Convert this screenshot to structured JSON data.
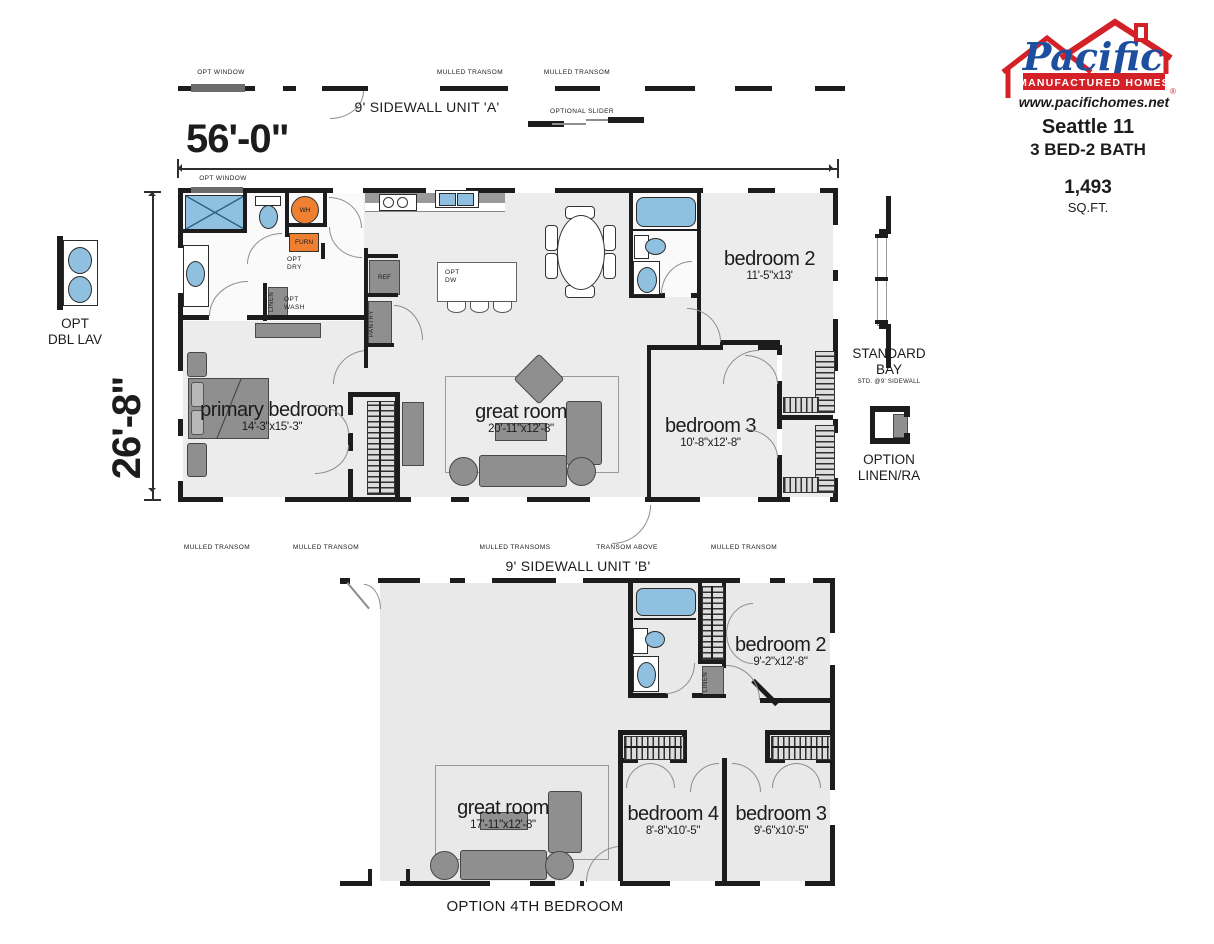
{
  "colors": {
    "brand_red": "#d42127",
    "brand_blue": "#1d4f9e",
    "fixture_blue": "#8fc0e0",
    "utility_orange": "#ef8032",
    "wall_black": "#1c1c1c",
    "floor_gray": "#ececec",
    "furniture_gray": "#8f8f8f"
  },
  "brand": {
    "script": "Pacific",
    "bar": "MANUFACTURED HOMES",
    "reg": "®",
    "website": "www.pacifichomes.net",
    "model": "Seattle 11",
    "beds_baths": "3 BED-2 BATH",
    "sqft": "1,493",
    "sqft_unit": "SQ.FT."
  },
  "dims": {
    "width": "56'-0\"",
    "height": "26'-8\""
  },
  "top": {
    "opt_window_bar": "OPT WINDOW",
    "opt_window_plan": "OPT WINDOW",
    "sidewall_a": "9' SIDEWALL UNIT 'A'",
    "mulled_1": "MULLED TRANSOM",
    "mulled_2": "MULLED TRANSOM",
    "optional_slider": "OPTIONAL SLIDER"
  },
  "left_side": {
    "opt_dbl_lav": "OPT\nDBL LAV"
  },
  "right_side": {
    "standard_bay": "STANDARD\nBAY",
    "std_note": "STD. @9' SIDEWALL",
    "option_linen": "OPTION\nLINEN/RA"
  },
  "unit_a": {
    "wh": "WH",
    "furn": "FURN",
    "opt_dry": "OPT\nDRY",
    "opt_wash": "OPT\nWASH",
    "linen": "LINEN",
    "ref": "REF",
    "pantry": "PANTRY",
    "opt_dw": "OPT\nDW",
    "rooms": {
      "primary": {
        "name": "primary bedroom",
        "dims": "14'-3\"x15'-3\""
      },
      "great": {
        "name": "great room",
        "dims": "20'-11\"x12'-8\""
      },
      "bed2": {
        "name": "bedroom 2",
        "dims": "11'-5\"x13'"
      },
      "bed3": {
        "name": "bedroom 3",
        "dims": "10'-8\"x12'-8\""
      }
    }
  },
  "mid": {
    "labels": [
      "MULLED TRANSOM",
      "MULLED TRANSOM",
      "MULLED TRANSOMS",
      "TRANSOM ABOVE",
      "MULLED TRANSOM"
    ],
    "sidewall_b": "9' SIDEWALL UNIT 'B'"
  },
  "unit_b": {
    "linen": "LINEN",
    "rooms": {
      "great": {
        "name": "great room",
        "dims": "17'-11\"x12'-8\""
      },
      "bed2": {
        "name": "bedroom 2",
        "dims": "9'-2\"x12'-8\""
      },
      "bed4": {
        "name": "bedroom 4",
        "dims": "8'-8\"x10'-5\""
      },
      "bed3": {
        "name": "bedroom 3",
        "dims": "9'-6\"x10'-5\""
      }
    },
    "caption": "OPTION 4TH BEDROOM"
  }
}
